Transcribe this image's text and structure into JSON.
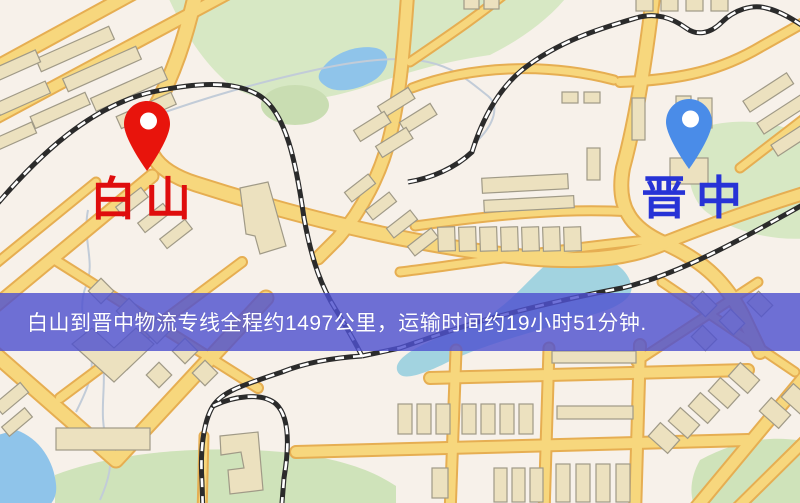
{
  "route_banner": {
    "text": "白山到晋中物流专线全程约1497公里，运输时间约19小时51分钟.",
    "background_color": "rgba(79,82,207,0.82)",
    "text_color": "#ffffff"
  },
  "route": {
    "origin": "白山",
    "destination": "晋中",
    "distance": "约1497公里",
    "duration": "约19小时51分钟"
  },
  "markers": {
    "origin": {
      "label": "白山",
      "pin_color": "#e8140c",
      "label_color": "#df0d0d"
    },
    "destination": {
      "label": "晋中",
      "pin_color": "#4a8ce8",
      "label_color": "#2733d6"
    }
  },
  "map_palette": {
    "background": "#f7f1ea",
    "road_fill": "#f7d77d",
    "road_casing": "#e6ae52",
    "building_fill": "#ece1bf",
    "building_outline": "#a09a87",
    "park_green": "#d7e8c4",
    "water_blue": "#8fc4ea",
    "railway_black": "#2b2b2b"
  }
}
